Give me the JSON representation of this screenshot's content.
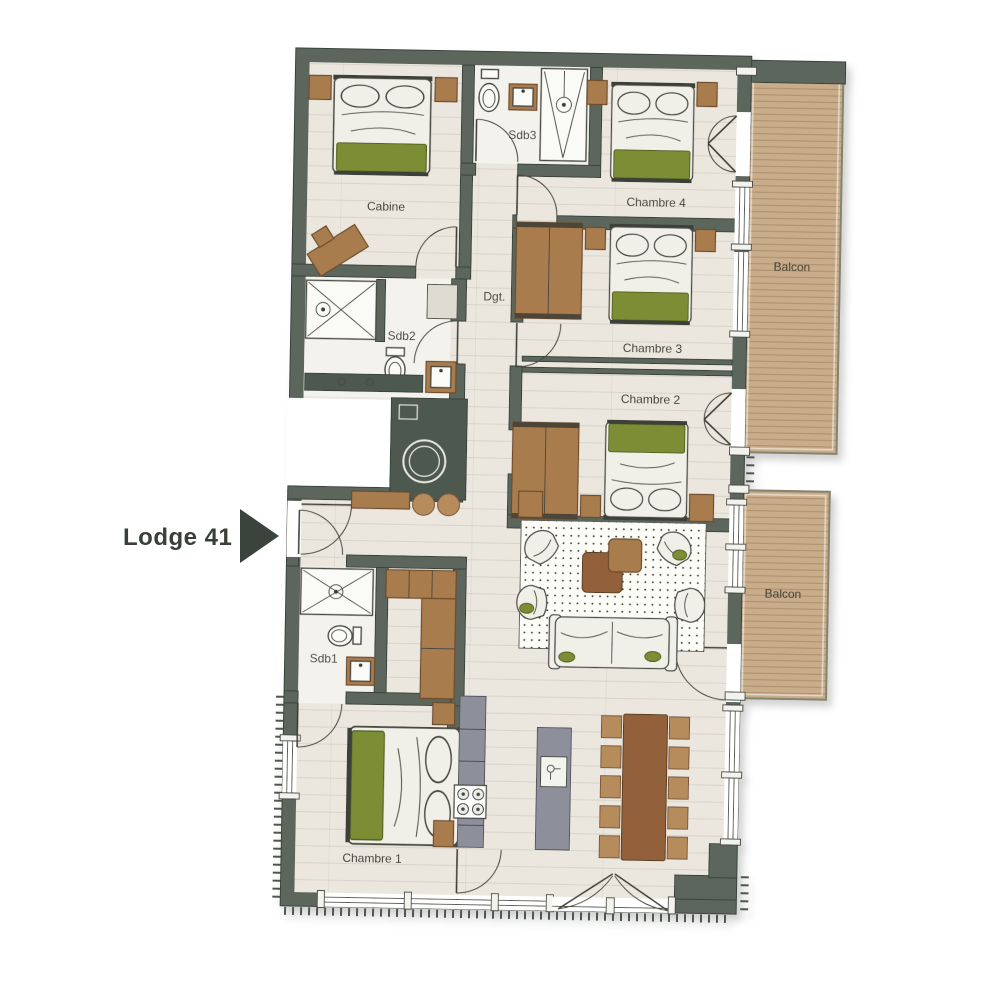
{
  "title": {
    "label": "Lodge 41"
  },
  "rooms": {
    "cabine": {
      "label": "Cabine"
    },
    "sdb3": {
      "label": "Sdb3"
    },
    "chambre4": {
      "label": "Chambre 4"
    },
    "dgt": {
      "label": "Dgt."
    },
    "sdb2": {
      "label": "Sdb2"
    },
    "chambre3": {
      "label": "Chambre 3"
    },
    "chambre2": {
      "label": "Chambre 2"
    },
    "sdb1": {
      "label": "Sdb1"
    },
    "chambre1": {
      "label": "Chambre 1"
    },
    "balcon_north": {
      "label": "Balcon"
    },
    "balcon_south": {
      "label": "Balcon"
    }
  },
  "colors": {
    "wall": "#5b665d",
    "floor": "#ebe7de",
    "bath_floor": "#f4f2ec",
    "deck": "#c9ad8a",
    "furniture_brown": "#a97c4e",
    "accent_green": "#7c8d35",
    "kitchen_gray": "#8d909b",
    "table_brown": "#92613a",
    "text": "#3c3c35",
    "title_text": "#394039"
  }
}
